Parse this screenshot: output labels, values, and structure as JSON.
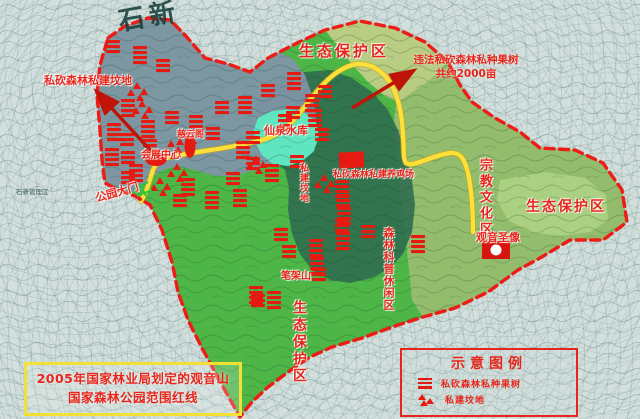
{
  "title_box": {
    "line1": "2005年国家林业局划定的观音山",
    "line2": "国家森林公园范围红线"
  },
  "legend": {
    "title": "示意图例",
    "items": [
      {
        "icon": "orchard-marker",
        "label": "私砍森林私种果树"
      },
      {
        "icon": "grave-marker",
        "label": "私建坟地"
      }
    ]
  },
  "zones": {
    "eco_top": "生态保护区",
    "eco_right": "生态保护区",
    "eco_bottom": "生态保护区",
    "religious": "宗教文化区",
    "forest_leisure": "森林科普休闲区"
  },
  "places": {
    "reservoir": "仙泉水库",
    "exhibition_center": "会展中心",
    "ciyun_pavilion": "慈云阁",
    "park_gate": "公园大门",
    "bijia_mountain": "笔架山",
    "guanyin_statue": "观音圣像",
    "shixin": "石新",
    "shixin_district": "石新管理区"
  },
  "annotations": {
    "graves_note": "私砍森林私建坟地",
    "orchard_note_line1": "违法私砍森林私种果树",
    "orchard_note_line2": "共约2000亩",
    "chicken_farm_note": "私砍森林私建养鸡场",
    "graves_vertical": "私建坟地"
  },
  "colors": {
    "boundary": "#ee1c16",
    "road": "#ffdf3a",
    "marker": "#e51a10",
    "gray_zone": "#8094a8",
    "lake": "#5fe6c0",
    "bright_green": "#4db647",
    "dark_green": "#2e6b50",
    "mid_green": "#93bd6d",
    "pale_green": "#b8cc82",
    "label_red": "#e8251a",
    "title_border_yellow": "#f2e134"
  },
  "markers": {
    "bar_sites": [
      [
        113,
        46
      ],
      [
        140,
        52
      ],
      [
        163,
        65
      ],
      [
        294,
        78
      ],
      [
        268,
        90
      ],
      [
        245,
        102
      ],
      [
        222,
        107
      ],
      [
        312,
        100
      ],
      [
        325,
        91
      ],
      [
        128,
        105
      ],
      [
        172,
        117
      ],
      [
        196,
        121
      ],
      [
        213,
        133
      ],
      [
        114,
        129
      ],
      [
        127,
        139
      ],
      [
        148,
        126
      ],
      [
        150,
        145
      ],
      [
        112,
        154
      ],
      [
        128,
        157
      ],
      [
        136,
        170
      ],
      [
        128,
        177
      ],
      [
        188,
        184
      ],
      [
        180,
        200
      ],
      [
        212,
        197
      ],
      [
        233,
        178
      ],
      [
        240,
        195
      ],
      [
        253,
        137
      ],
      [
        285,
        120
      ],
      [
        293,
        112
      ],
      [
        243,
        147
      ],
      [
        253,
        163
      ],
      [
        272,
        170
      ],
      [
        297,
        161
      ],
      [
        315,
        115
      ],
      [
        322,
        134
      ],
      [
        342,
        186
      ],
      [
        343,
        200
      ],
      [
        344,
        213
      ],
      [
        342,
        225
      ],
      [
        343,
        238
      ],
      [
        281,
        234
      ],
      [
        316,
        245
      ],
      [
        289,
        251
      ],
      [
        317,
        263
      ],
      [
        368,
        231
      ],
      [
        418,
        241
      ],
      [
        319,
        274
      ],
      [
        256,
        292
      ],
      [
        258,
        300
      ],
      [
        274,
        297
      ]
    ],
    "grave_sites": [
      [
        137,
        87
      ],
      [
        142,
        105
      ],
      [
        186,
        136
      ],
      [
        171,
        145
      ],
      [
        177,
        168
      ],
      [
        160,
        182
      ],
      [
        256,
        160
      ],
      [
        324,
        179
      ]
    ]
  }
}
